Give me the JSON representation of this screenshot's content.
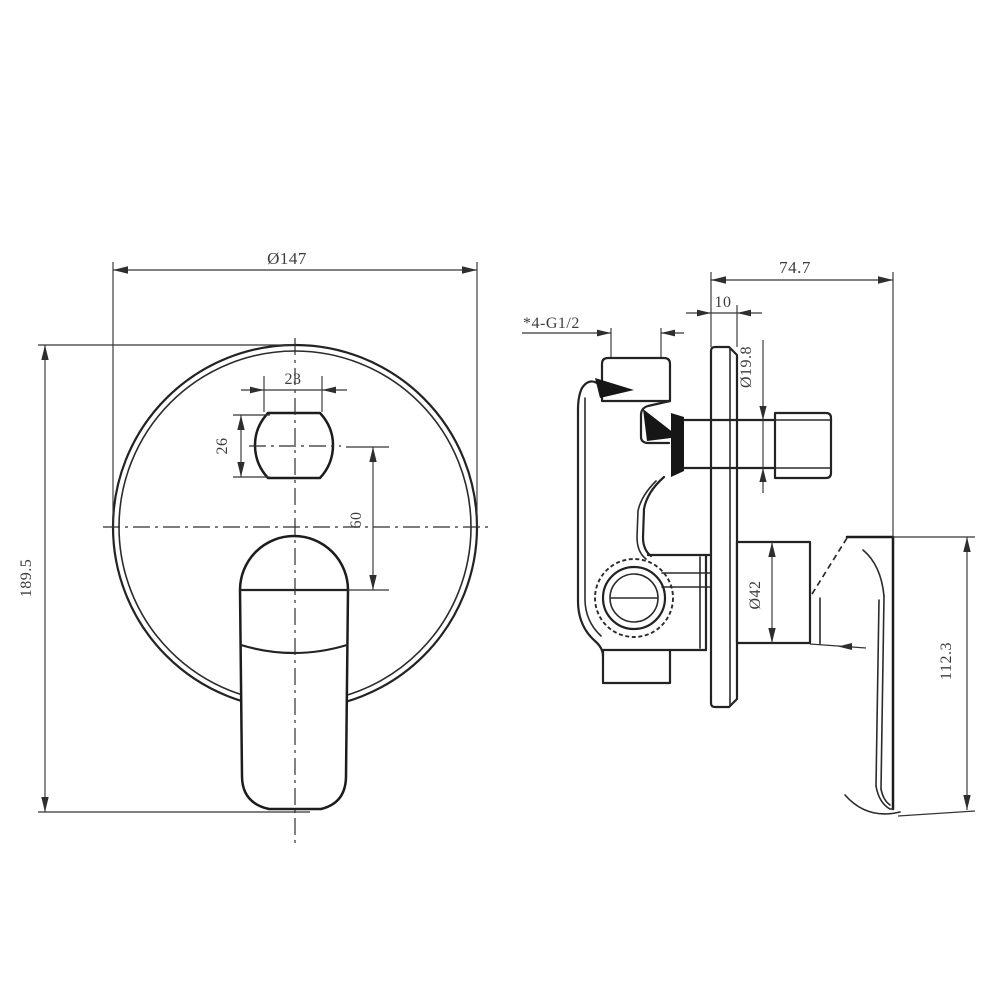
{
  "drawing": {
    "type": "technical-drawing",
    "subject": "concealed shower mixer valve, front and side views",
    "colors": {
      "background": "#ffffff",
      "line": "#232323",
      "dimension_text": "#3d3d3d"
    }
  },
  "views": {
    "front": {
      "dimensions": [
        {
          "id": "faceplate-diameter",
          "label": "Ø147"
        },
        {
          "id": "overall-height",
          "label": "189.5"
        },
        {
          "id": "nut-width",
          "label": "23"
        },
        {
          "id": "nut-height",
          "label": "26"
        },
        {
          "id": "diverter-offset",
          "label": "60"
        }
      ]
    },
    "side": {
      "dimensions": [
        {
          "id": "overall-depth",
          "label": "74.7"
        },
        {
          "id": "plate-thickness",
          "label": "10"
        },
        {
          "id": "thread-spec",
          "label": "*4-G1/2"
        },
        {
          "id": "outlet-diameter",
          "label": "Ø19.8"
        },
        {
          "id": "boss-diameter",
          "label": "Ø42"
        },
        {
          "id": "handle-height",
          "label": "112.3"
        }
      ]
    }
  }
}
